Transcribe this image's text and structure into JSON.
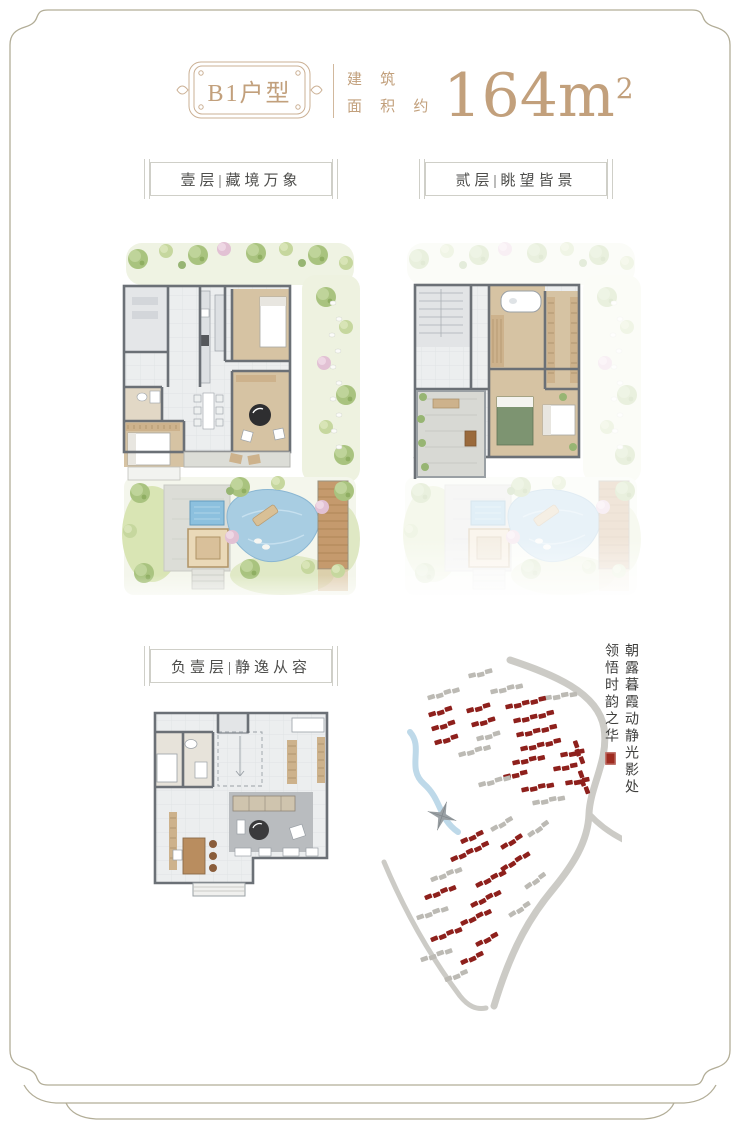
{
  "page": {
    "frame_color": "#b2ad97",
    "background": "#ffffff"
  },
  "header": {
    "plaque_label": "B1户型",
    "area_prefix": [
      "建 筑",
      "面 积 约"
    ],
    "area_value": "164m",
    "area_exponent": "2",
    "accent_color": "#c2a07c"
  },
  "section_labels": {
    "floor1": "壹层|藏境万象",
    "floor2": "贰层|眺望皆景",
    "basement": "负壹层|静逸从容"
  },
  "calligraphy": {
    "right_column": "朝露暮霞动静光影处",
    "left_column": "领悟时韵之华",
    "seal_color": "#9e2b20"
  },
  "plan_colors": {
    "wall": "#6b7076",
    "floor_light": "#eceeef",
    "floor_wood": "#d6c3a3",
    "water": "#a8cde2",
    "deck": "#c59a6d",
    "lawn": "#d9e5b4"
  },
  "site_map": {
    "road_color": "#cccbc6",
    "river_color": "#bed9e9",
    "building_red": "#8e201c",
    "building_gray": "#bcbab4",
    "compass_color": "#9aa0a4",
    "rows": [
      {
        "x": 96,
        "y": 18,
        "a": -14,
        "n": 3,
        "c": "gray"
      },
      {
        "x": 55,
        "y": 40,
        "a": -18,
        "n": 4,
        "c": "gray"
      },
      {
        "x": 118,
        "y": 34,
        "a": -14,
        "n": 4,
        "c": "gray"
      },
      {
        "x": 172,
        "y": 40,
        "a": -10,
        "n": 4,
        "c": "gray"
      },
      {
        "x": 56,
        "y": 57,
        "a": -18,
        "n": 3,
        "c": "red"
      },
      {
        "x": 94,
        "y": 53,
        "a": -16,
        "n": 3,
        "c": "red"
      },
      {
        "x": 133,
        "y": 49,
        "a": -13,
        "n": 5,
        "c": "red"
      },
      {
        "x": 59,
        "y": 71,
        "a": -18,
        "n": 3,
        "c": "red"
      },
      {
        "x": 99,
        "y": 67,
        "a": -16,
        "n": 3,
        "c": "red"
      },
      {
        "x": 141,
        "y": 63,
        "a": -13,
        "n": 5,
        "c": "red"
      },
      {
        "x": 62,
        "y": 85,
        "a": -18,
        "n": 3,
        "c": "red"
      },
      {
        "x": 104,
        "y": 81,
        "a": -16,
        "n": 3,
        "c": "gray"
      },
      {
        "x": 144,
        "y": 77,
        "a": -13,
        "n": 5,
        "c": "red"
      },
      {
        "x": 148,
        "y": 91,
        "a": -13,
        "n": 5,
        "c": "red"
      },
      {
        "x": 86,
        "y": 97,
        "a": -17,
        "n": 4,
        "c": "gray"
      },
      {
        "x": 140,
        "y": 105,
        "a": -13,
        "n": 4,
        "c": "red"
      },
      {
        "x": 188,
        "y": 97,
        "a": -11,
        "n": 3,
        "c": "red"
      },
      {
        "x": 131,
        "y": 119,
        "a": -13,
        "n": 3,
        "c": "red"
      },
      {
        "x": 181,
        "y": 111,
        "a": -11,
        "n": 3,
        "c": "red"
      },
      {
        "x": 149,
        "y": 132,
        "a": -12,
        "n": 4,
        "c": "red"
      },
      {
        "x": 193,
        "y": 125,
        "a": -10,
        "n": 3,
        "c": "red"
      },
      {
        "x": 106,
        "y": 127,
        "a": -16,
        "n": 4,
        "c": "gray"
      },
      {
        "x": 160,
        "y": 145,
        "a": -12,
        "n": 4,
        "c": "gray"
      },
      {
        "x": 205,
        "y": 84,
        "a": 70,
        "n": 3,
        "c": "red"
      },
      {
        "x": 210,
        "y": 114,
        "a": 70,
        "n": 3,
        "c": "red"
      },
      {
        "x": 118,
        "y": 172,
        "a": -30,
        "n": 3,
        "c": "gray"
      },
      {
        "x": 155,
        "y": 178,
        "a": -36,
        "n": 3,
        "c": "gray"
      },
      {
        "x": 88,
        "y": 184,
        "a": -25,
        "n": 3,
        "c": "red"
      },
      {
        "x": 128,
        "y": 190,
        "a": -32,
        "n": 3,
        "c": "red"
      },
      {
        "x": 78,
        "y": 202,
        "a": -25,
        "n": 5,
        "c": "red"
      },
      {
        "x": 128,
        "y": 212,
        "a": -33,
        "n": 4,
        "c": "red"
      },
      {
        "x": 58,
        "y": 222,
        "a": -22,
        "n": 4,
        "c": "gray"
      },
      {
        "x": 103,
        "y": 228,
        "a": -28,
        "n": 4,
        "c": "red"
      },
      {
        "x": 152,
        "y": 230,
        "a": -36,
        "n": 3,
        "c": "gray"
      },
      {
        "x": 52,
        "y": 240,
        "a": -22,
        "n": 4,
        "c": "red"
      },
      {
        "x": 98,
        "y": 248,
        "a": -28,
        "n": 4,
        "c": "red"
      },
      {
        "x": 44,
        "y": 260,
        "a": -20,
        "n": 4,
        "c": "gray"
      },
      {
        "x": 88,
        "y": 266,
        "a": -26,
        "n": 4,
        "c": "red"
      },
      {
        "x": 136,
        "y": 258,
        "a": -33,
        "n": 3,
        "c": "gray"
      },
      {
        "x": 58,
        "y": 282,
        "a": -22,
        "n": 4,
        "c": "red"
      },
      {
        "x": 103,
        "y": 287,
        "a": -28,
        "n": 3,
        "c": "red"
      },
      {
        "x": 48,
        "y": 302,
        "a": -20,
        "n": 4,
        "c": "gray"
      },
      {
        "x": 88,
        "y": 305,
        "a": -25,
        "n": 3,
        "c": "red"
      },
      {
        "x": 72,
        "y": 322,
        "a": -22,
        "n": 3,
        "c": "gray"
      }
    ]
  }
}
